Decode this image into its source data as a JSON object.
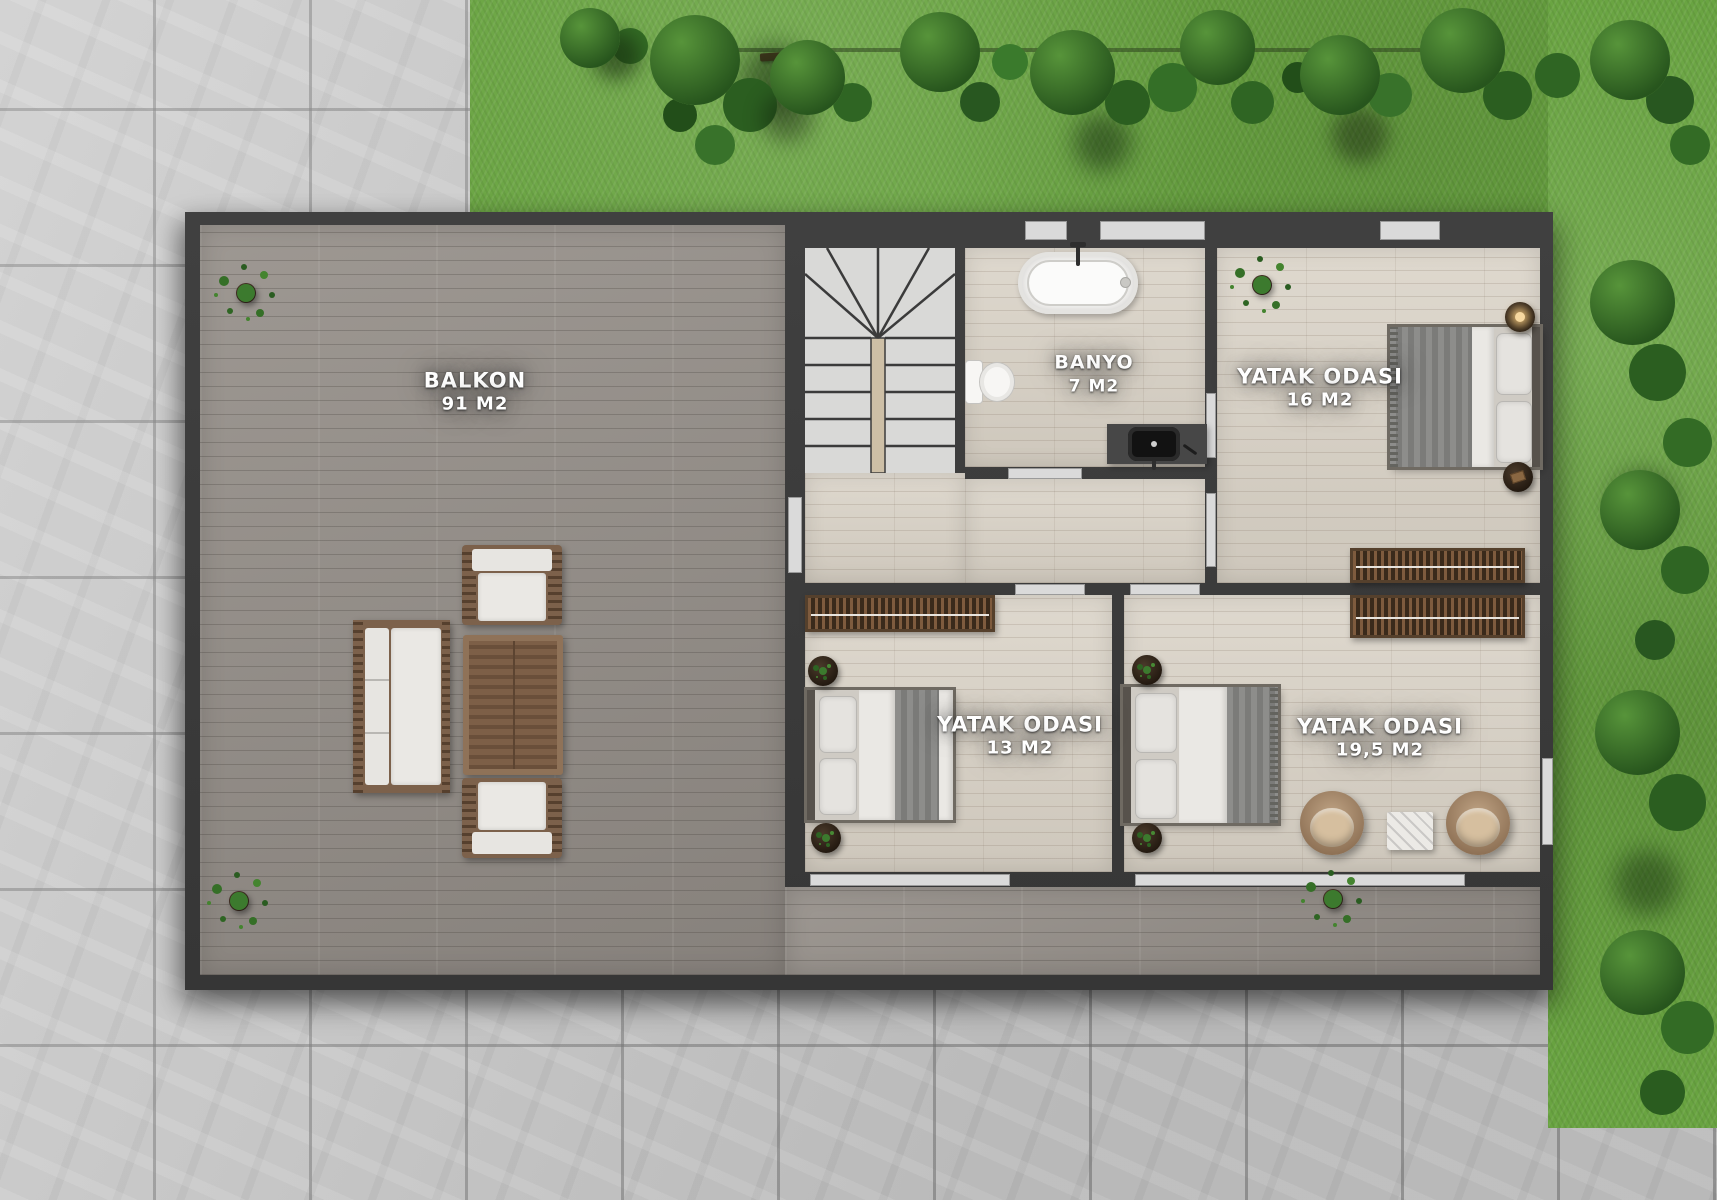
{
  "plan": {
    "rooms": [
      {
        "id": "balkon",
        "name": "BALKON",
        "area": "91 M2"
      },
      {
        "id": "banyo",
        "name": "BANYO",
        "area": "7 M2"
      },
      {
        "id": "yatak-16",
        "name": "YATAK ODASI",
        "area": "16 M2"
      },
      {
        "id": "yatak-13",
        "name": "YATAK ODASI",
        "area": "13 M2"
      },
      {
        "id": "yatak-19",
        "name": "YATAK ODASI",
        "area": "19,5 M2"
      }
    ],
    "colors": {
      "wall": "#3a3a3a",
      "interior_floor": "#d9d2c6",
      "deck": "#96908a",
      "tile": "#c7c7c7",
      "grass": "#69a441",
      "closet_wood": "#4e3a28",
      "sill": "#dadada",
      "label_text": "#ffffff"
    },
    "furniture": [
      "staircase",
      "bathtub",
      "toilet",
      "washbasin-vanity",
      "double-bed",
      "wardrobe",
      "side-table",
      "potted-plant",
      "tub-armchair",
      "coffee-table",
      "garden-sofa",
      "garden-armchair",
      "garden-table"
    ]
  }
}
